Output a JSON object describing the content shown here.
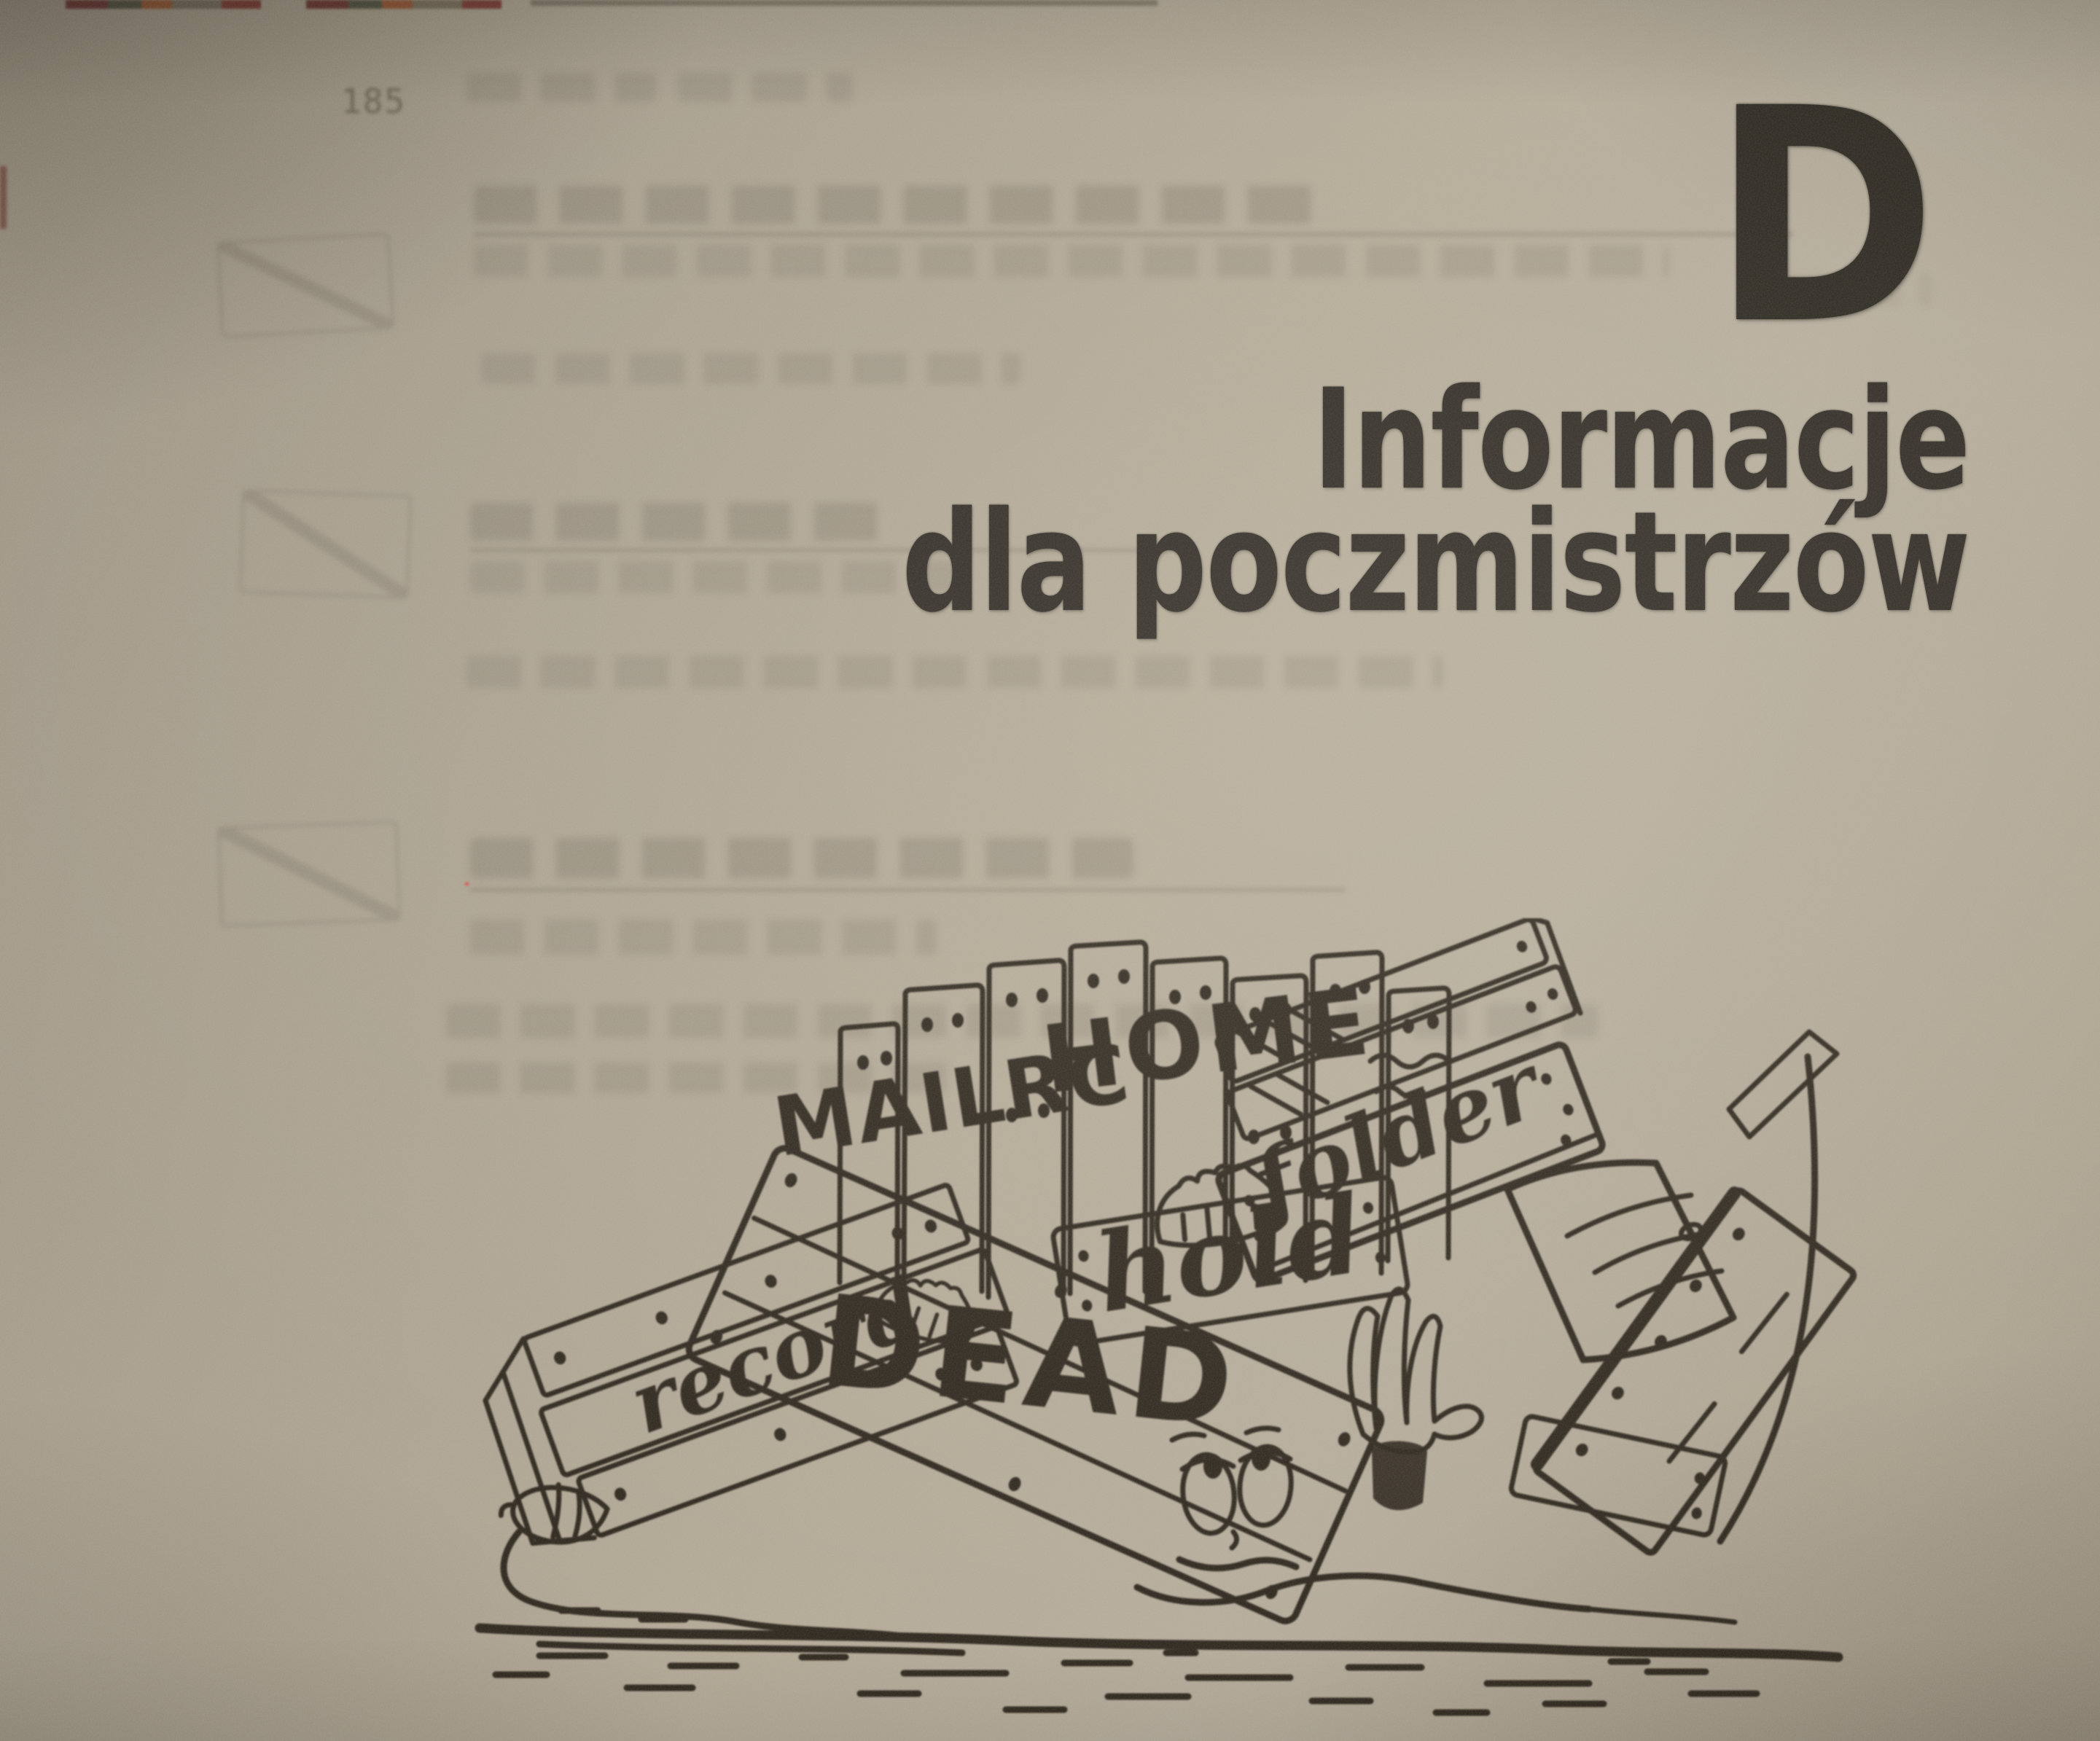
{
  "page": {
    "appendix_letter": "D",
    "title_line1": "Informacje",
    "title_line2": "dla poczmistrzów",
    "ghost_page_number": "185"
  },
  "illustration": {
    "sign_labels": {
      "mailrc": "MAILRC",
      "home": "HOME",
      "hold": "hold",
      "folder": "folder",
      "record": "record",
      "dead": "DEAD"
    }
  },
  "colors": {
    "paper": "#b0a695",
    "title_ink": "#29251f",
    "illustration_ink": "#2b241b"
  }
}
